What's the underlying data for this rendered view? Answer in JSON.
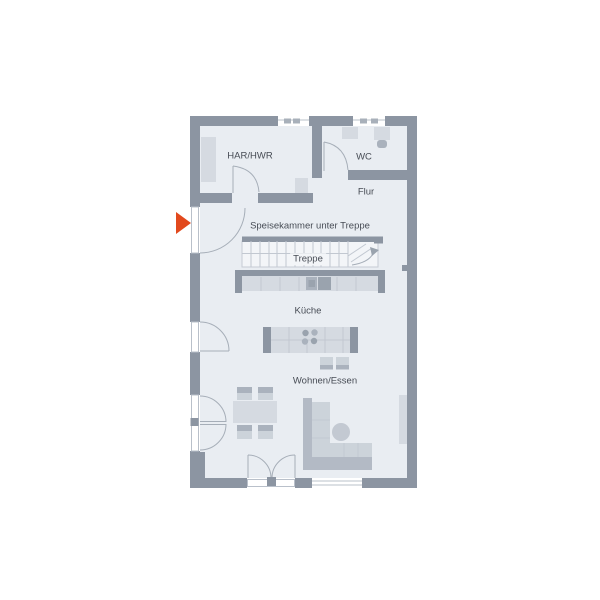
{
  "title": "Erdgeschoss Grundriss",
  "rooms": {
    "har_hwr": {
      "label": "HAR/HWR"
    },
    "wc": {
      "label": "WC"
    },
    "flur": {
      "label": "Flur"
    },
    "speisekammer": {
      "label": "Speisekammer unter Treppe"
    },
    "treppe": {
      "label": "Treppe"
    },
    "kueche": {
      "label": "Küche"
    },
    "wohnen_essen": {
      "label": "Wohnen/Essen"
    }
  },
  "markers": {
    "entrance": {
      "symbol": "arrow-right",
      "meaning": "Eingang",
      "color": "#e2491d"
    }
  },
  "colors": {
    "wall": "#8c95a2",
    "floor": "#e9edf2",
    "stair_floor": "#f3f5f8",
    "furniture": "#d5dae1",
    "furniture_band": "#aab2bd",
    "sofa_back": "#b3bac5",
    "cushion": "#ccd3da",
    "appliance": "#9aa3ae",
    "accent": "#e2491d",
    "text": "#474c55",
    "background": "#ffffff"
  }
}
